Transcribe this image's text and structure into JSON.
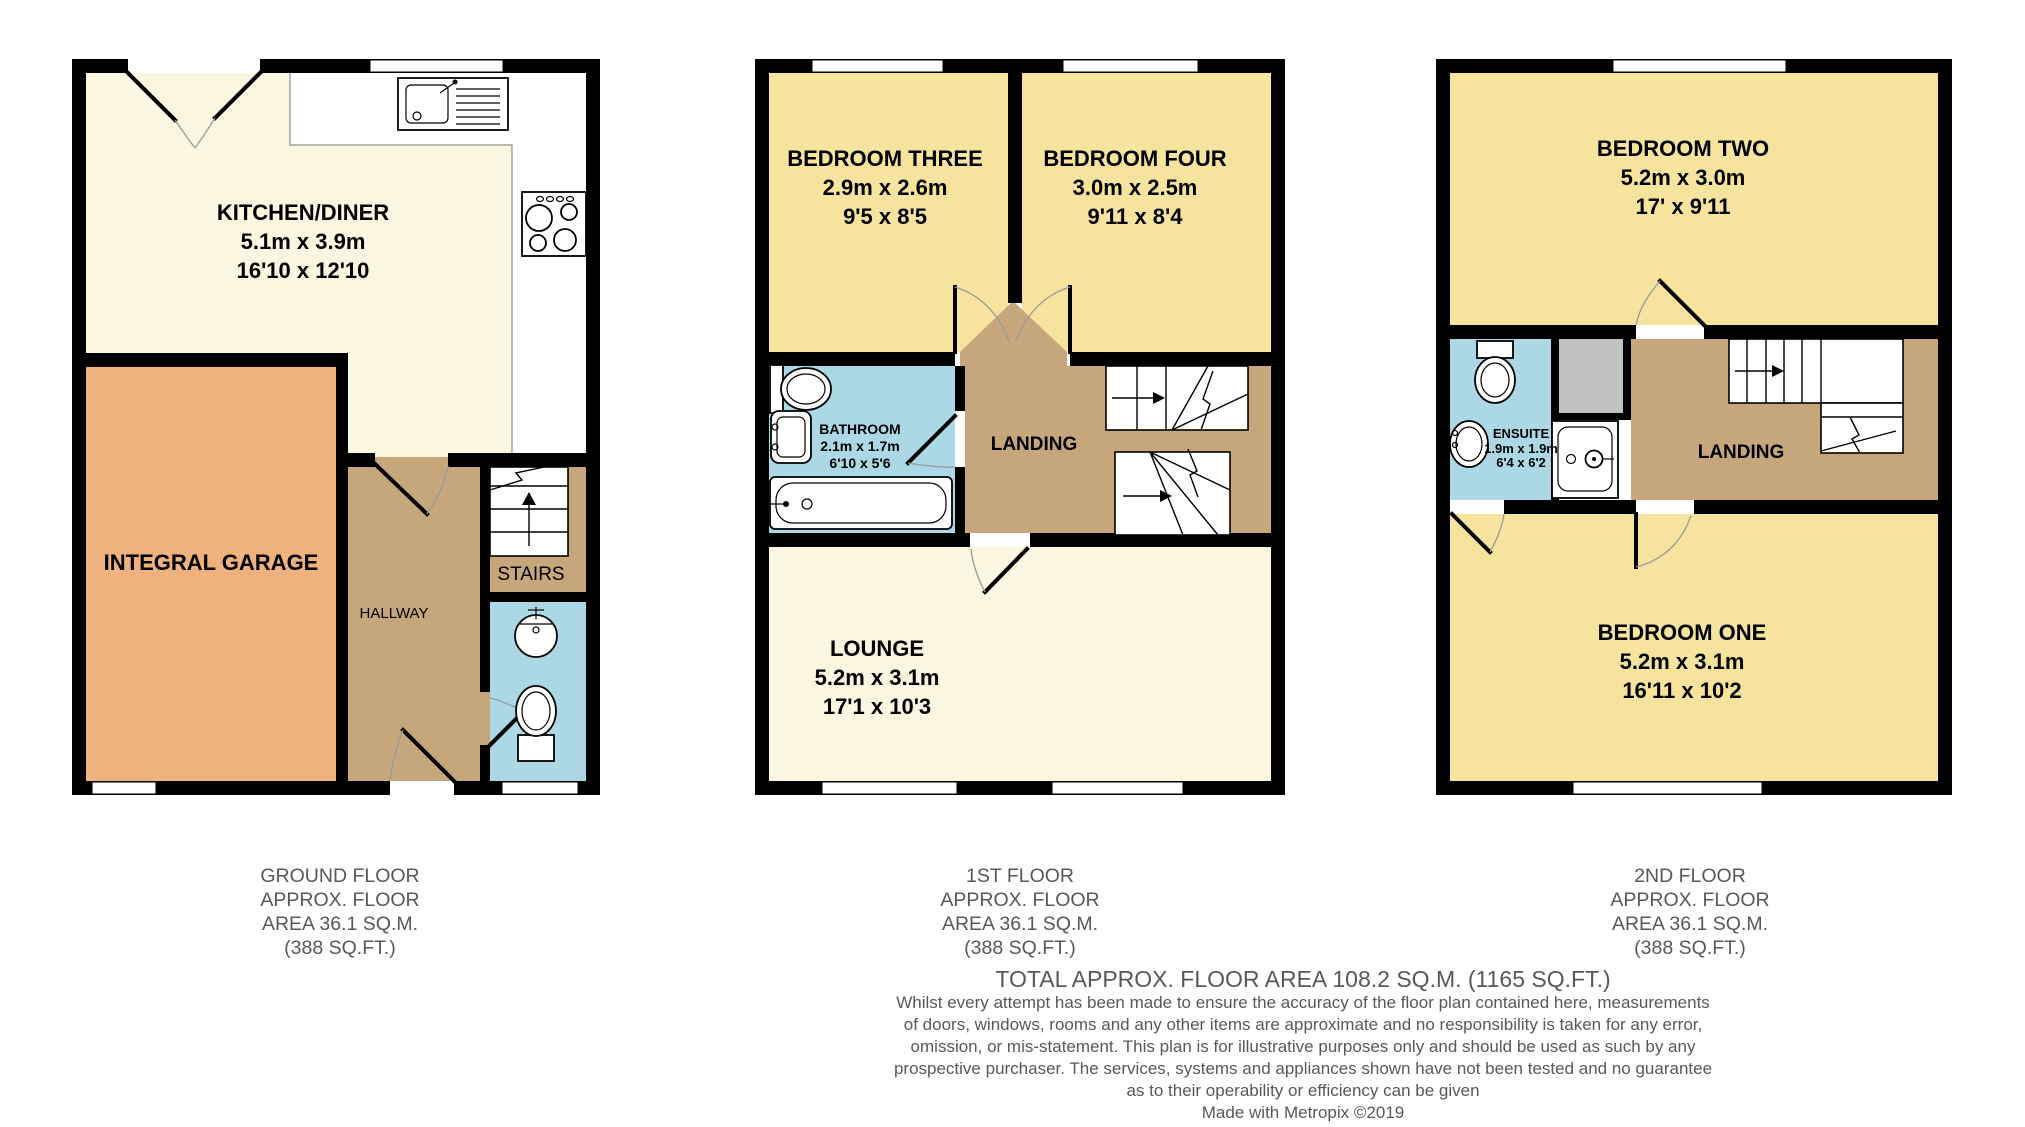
{
  "floors": {
    "ground": {
      "caption": [
        "GROUND FLOOR",
        "APPROX. FLOOR",
        "AREA 36.1 SQ.M.",
        "(388 SQ.FT.)"
      ],
      "rooms": {
        "kitchen": {
          "name": "KITCHEN/DINER",
          "metric": "5.1m x 3.9m",
          "imperial": "16'10 x 12'10"
        },
        "garage": {
          "name": "INTEGRAL GARAGE"
        },
        "hallway": {
          "name": "HALLWAY"
        },
        "stairs": {
          "name": "STAIRS"
        }
      }
    },
    "first": {
      "caption": [
        "1ST FLOOR",
        "APPROX. FLOOR",
        "AREA 36.1 SQ.M.",
        "(388 SQ.FT.)"
      ],
      "rooms": {
        "bedroom_three": {
          "name": "BEDROOM THREE",
          "metric": "2.9m x 2.6m",
          "imperial": "9'5 x 8'5"
        },
        "bedroom_four": {
          "name": "BEDROOM FOUR",
          "metric": "3.0m x 2.5m",
          "imperial": "9'11 x 8'4"
        },
        "bathroom": {
          "name": "BATHROOM",
          "metric": "2.1m x 1.7m",
          "imperial": "6'10 x 5'6"
        },
        "landing": {
          "name": "LANDING"
        },
        "lounge": {
          "name": "LOUNGE",
          "metric": "5.2m x 3.1m",
          "imperial": "17'1 x 10'3"
        }
      }
    },
    "second": {
      "caption": [
        "2ND FLOOR",
        "APPROX. FLOOR",
        "AREA 36.1 SQ.M.",
        "(388 SQ.FT.)"
      ],
      "rooms": {
        "bedroom_two": {
          "name": "BEDROOM TWO",
          "metric": "5.2m x 3.0m",
          "imperial": "17' x 9'11"
        },
        "ensuite": {
          "name": "ENSUITE",
          "metric": "1.9m x 1.9m",
          "imperial": "6'4 x 6'2"
        },
        "landing": {
          "name": "LANDING"
        },
        "bedroom_one": {
          "name": "BEDROOM ONE",
          "metric": "5.2m x 3.1m",
          "imperial": "16'11 x 10'2"
        }
      }
    }
  },
  "footer": {
    "total": "TOTAL APPROX. FLOOR AREA 108.2 SQ.M. (1165 SQ.FT.)",
    "disclaimer": [
      "Whilst every attempt has been made to ensure the accuracy of the floor plan contained here, measurements",
      "of doors, windows, rooms and any other items are approximate and no responsibility is taken for any error,",
      "omission, or mis-statement. This plan is for illustrative purposes only and should be used as such by any",
      "prospective purchaser. The services, systems and appliances shown have not been tested and no guarantee",
      "as to their operability or efficiency can be given"
    ],
    "credit": "Made with Metropix ©2019"
  },
  "palette": {
    "room_cream": "#FBF6DF",
    "room_yellow": "#F6E49E",
    "garage_orange": "#EFB27E",
    "hall_tan": "#C6A77C",
    "bath_blue": "#ACD8E5",
    "cupboard_gray": "#C2C2C2",
    "wall_black": "#000000",
    "caption_gray": "#58585A"
  }
}
